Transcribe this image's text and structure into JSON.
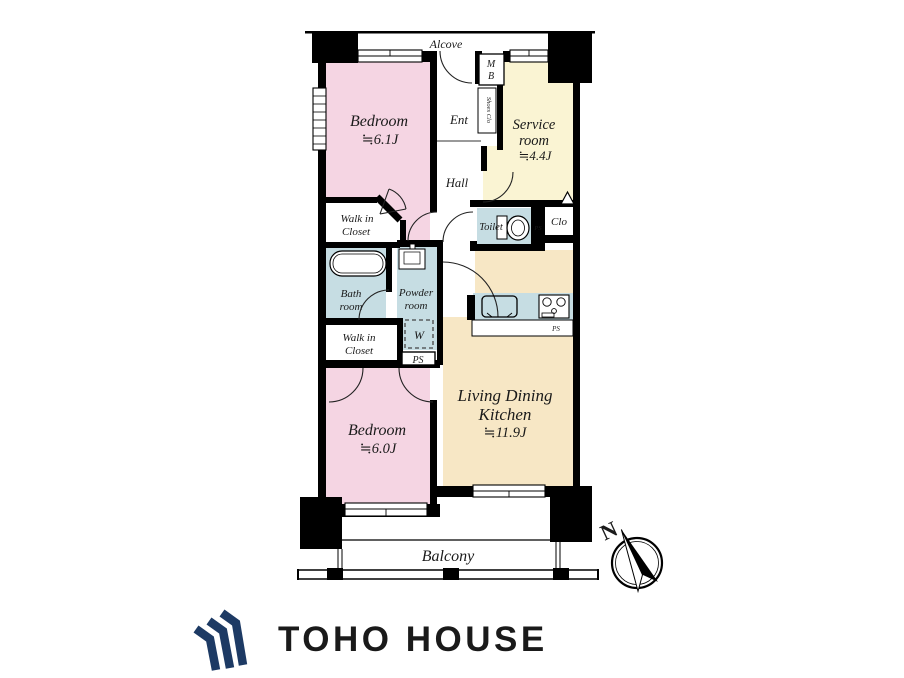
{
  "colors": {
    "bedroom": "#F5D5E3",
    "service": "#FAF4D3",
    "ldk": "#F7E7C5",
    "wet": "#C6DDE3",
    "wall": "#000000",
    "logo": "#1D3A64"
  },
  "plan": {
    "alcove": "Alcove",
    "mb": {
      "line1": "M",
      "line2": "B"
    },
    "ent": "Ent",
    "shoes_clo": "Shoes Clo",
    "service": {
      "line1": "Service",
      "line2": "room",
      "size": "≒4.4J"
    },
    "hall": "Hall",
    "bedroom1": {
      "name": "Bedroom",
      "size": "≒6.1J"
    },
    "wic1": {
      "line1": "Walk in",
      "line2": "Closet"
    },
    "toilet": "Toilet",
    "clo": "Clo",
    "ps": "PS",
    "bath": {
      "line1": "Bath",
      "line2": "room"
    },
    "powder": {
      "line1": "Powder",
      "line2": "room"
    },
    "w": "W",
    "wic2": {
      "line1": "Walk in",
      "line2": "Closet"
    },
    "bedroom2": {
      "name": "Bedroom",
      "size": "≒6.0J"
    },
    "ldk": {
      "line1": "Living Dining",
      "line2": "Kitchen",
      "size": "≒11.9J"
    },
    "balcony": "Balcony",
    "north": "N"
  },
  "logo": {
    "text": "TOHO HOUSE"
  }
}
